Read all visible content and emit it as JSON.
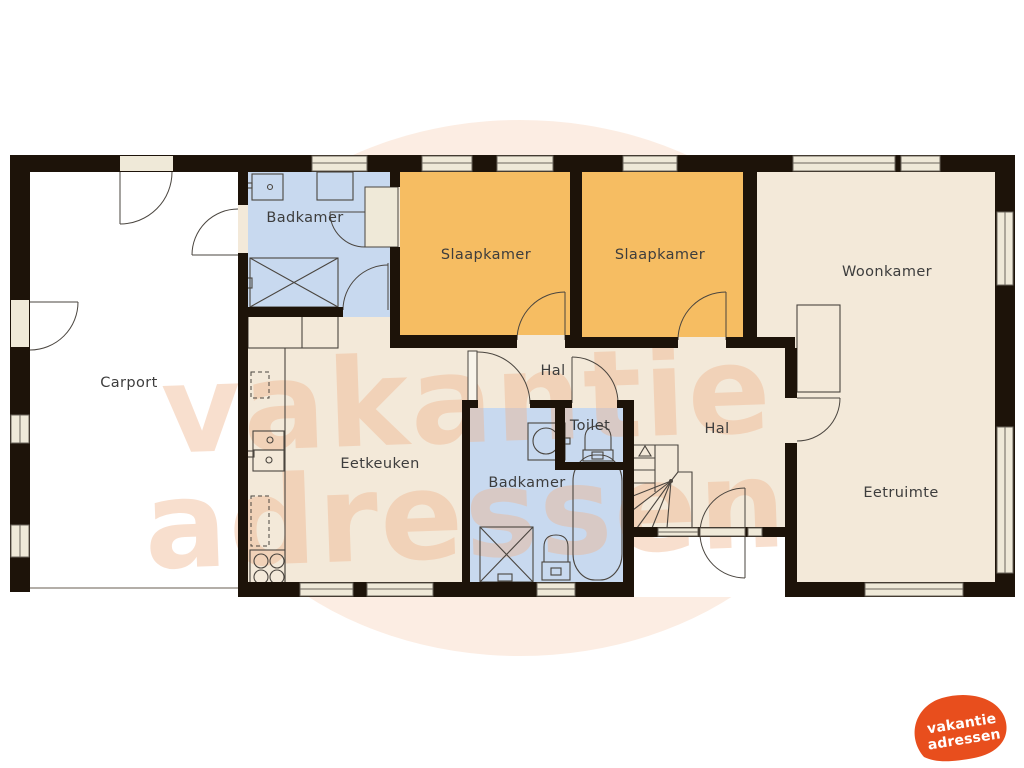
{
  "watermark": {
    "line1": "vakantie",
    "line2": "adressen"
  },
  "logo": {
    "line1": "vakantie",
    "line2": "adressen"
  },
  "colors": {
    "wall": "#1d1309",
    "bathroom": "#c8d9ef",
    "bedroom": "#f6bd62",
    "living": "#f3e9d9",
    "carport": "#ffffff",
    "window": "#efe9d8",
    "frame": "#6b655c",
    "line": "#4a453f",
    "label": "#3d3d3d",
    "watermark": "#f0b48d",
    "watermarkblob": "#fbe7da",
    "brand": "#e84e1d",
    "brandtext": "#ffffff"
  },
  "rooms": [
    {
      "id": "carport",
      "label": "Carport",
      "x": 129,
      "y": 387
    },
    {
      "id": "badkamer-1",
      "label": "Badkamer",
      "x": 305,
      "y": 222
    },
    {
      "id": "slaapkamer-1",
      "label": "Slaapkamer",
      "x": 486,
      "y": 259
    },
    {
      "id": "slaapkamer-2",
      "label": "Slaapkamer",
      "x": 660,
      "y": 259
    },
    {
      "id": "woonkamer",
      "label": "Woonkamer",
      "x": 887,
      "y": 276
    },
    {
      "id": "hal-1",
      "label": "Hal",
      "x": 553,
      "y": 375
    },
    {
      "id": "toilet",
      "label": "Toilet",
      "x": 590,
      "y": 430
    },
    {
      "id": "hal-2",
      "label": "Hal",
      "x": 717,
      "y": 433
    },
    {
      "id": "badkamer-2",
      "label": "Badkamer",
      "x": 527,
      "y": 487
    },
    {
      "id": "eetkeuken",
      "label": "Eetkeuken",
      "x": 380,
      "y": 468
    },
    {
      "id": "eetruimte",
      "label": "Eetruimte",
      "x": 901,
      "y": 497
    }
  ]
}
